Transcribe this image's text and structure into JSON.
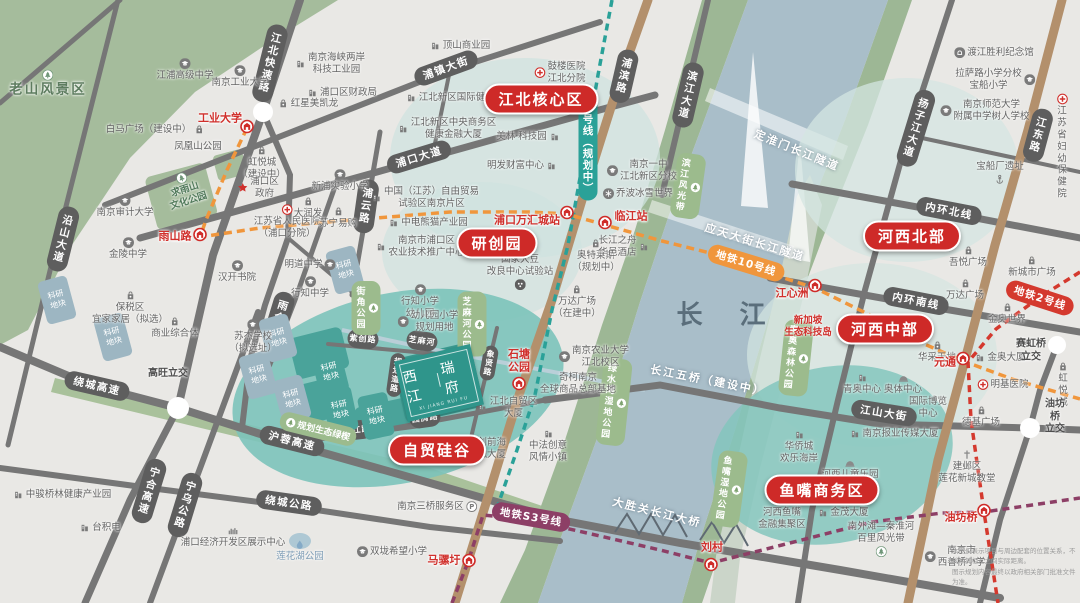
{
  "map": {
    "project_logo": {
      "name": "西江瑞府",
      "line1": "西江",
      "line2": "瑞府",
      "sub": "XI JIANG RUI FU"
    },
    "river_label": "长 江",
    "disclaimer_line1": "本图仅表示项目与周边配套的位置关系，不反映其相互之间实际距离。",
    "disclaimer_line2": "图示规划内容最终以政府相关部门批准文件为准。",
    "research_block_label": "科研\n地块",
    "colors": {
      "badge_red": "#ce2a28",
      "metro10_orange": "#f0963c",
      "metro11_teal": "#2aa198",
      "metro2_red": "#d4392e",
      "metroS3_purple": "#8d3f66",
      "road_gray": "#767676",
      "avenue_tan": "#b3906c",
      "river_blue": "#a9bec9",
      "park_green": "#a5bc9c",
      "zone_teal": "#7cc3ba"
    },
    "area_badges": [
      {
        "t": "江北核心区",
        "x": 541,
        "y": 99
      },
      {
        "t": "研创园",
        "x": 497,
        "y": 243
      },
      {
        "t": "自贸硅谷",
        "x": 437,
        "y": 450
      },
      {
        "t": "河西北部",
        "x": 912,
        "y": 236
      },
      {
        "t": "河西中部",
        "x": 885,
        "y": 329
      },
      {
        "t": "鱼嘴商务区",
        "x": 822,
        "y": 490
      }
    ],
    "metro_pills": [
      {
        "t": "11号线（规划中）",
        "x": 588,
        "y": 145,
        "vert": 1,
        "color": "#2aa198"
      },
      {
        "t": "地铁10号线",
        "x": 746,
        "y": 263,
        "rot": 17,
        "color": "#f0963c"
      },
      {
        "t": "地铁2号线",
        "x": 1040,
        "y": 298,
        "rot": 18,
        "color": "#d4392e"
      },
      {
        "t": "地铁S3号线",
        "x": 531,
        "y": 517,
        "rot": 10,
        "color": "#8d3f66"
      }
    ],
    "stations": [
      {
        "t": "工业大学",
        "ix": 247,
        "iy": 128,
        "tx": 220,
        "ty": 119
      },
      {
        "t": "雨山路",
        "ix": 200,
        "iy": 236,
        "tx": 175,
        "ty": 237
      },
      {
        "t": "浦口万汇城站",
        "ix": 567,
        "iy": 214,
        "tx": 527,
        "ty": 221
      },
      {
        "t": "临江站",
        "ix": 605,
        "iy": 224,
        "tx": 631,
        "ty": 217
      },
      {
        "t": "石塘\n公园",
        "ix": 519,
        "iy": 385,
        "tx": 519,
        "ty": 361
      },
      {
        "t": "江心洲",
        "ix": 815,
        "iy": 287,
        "tx": 792,
        "ty": 294
      },
      {
        "t": "元通",
        "ix": 963,
        "iy": 360,
        "tx": 945,
        "ty": 363
      },
      {
        "t": "油坊桥",
        "ix": 984,
        "iy": 512,
        "tx": 961,
        "ty": 518
      },
      {
        "t": "马骡圩",
        "ix": 469,
        "iy": 562,
        "tx": 444,
        "ty": 561
      },
      {
        "t": "刘村",
        "ix": 711,
        "iy": 566,
        "tx": 712,
        "ty": 548
      }
    ],
    "road_pills": [
      {
        "t": "江北快速路",
        "x": 270,
        "y": 63,
        "vert": 1,
        "rot": 14
      },
      {
        "t": "浦镇大街",
        "x": 446,
        "y": 68,
        "rot": -20
      },
      {
        "t": "浦口大道",
        "x": 419,
        "y": 157,
        "rot": -17
      },
      {
        "t": "浦云路",
        "x": 366,
        "y": 206,
        "vert": 1,
        "rot": 8
      },
      {
        "t": "浦滨路",
        "x": 624,
        "y": 76,
        "vert": 1,
        "rot": 13
      },
      {
        "t": "滨江大道",
        "x": 688,
        "y": 95,
        "vert": 1,
        "rot": 13
      },
      {
        "t": "扬子江大道",
        "x": 916,
        "y": 128,
        "vert": 1,
        "rot": 17
      },
      {
        "t": "江东路",
        "x": 1038,
        "y": 135,
        "vert": 1,
        "rot": 15
      },
      {
        "t": "沿山大道",
        "x": 63,
        "y": 239,
        "vert": 1,
        "rot": 14
      },
      {
        "t": "雨合路",
        "x": 279,
        "y": 318,
        "vert": 1,
        "rot": 17
      },
      {
        "t": "绕城高速",
        "x": 97,
        "y": 386,
        "rot": 13
      },
      {
        "t": "沪蓉高速",
        "x": 292,
        "y": 441,
        "rot": 14
      },
      {
        "t": "宁合高速",
        "x": 149,
        "y": 491,
        "vert": 1,
        "rot": 17
      },
      {
        "t": "宁乌公路",
        "x": 185,
        "y": 505,
        "vert": 1,
        "rot": 17
      },
      {
        "t": "绕城公路",
        "x": 289,
        "y": 503,
        "rot": 8
      },
      {
        "t": "内环北线",
        "x": 949,
        "y": 211,
        "rot": 11
      },
      {
        "t": "内环南线",
        "x": 916,
        "y": 301,
        "rot": 11
      },
      {
        "t": "江山大街",
        "x": 884,
        "y": 413,
        "rot": 9
      },
      {
        "t": "紫创路",
        "x": 363,
        "y": 339,
        "rot": 5,
        "small": 1
      },
      {
        "t": "象贤路",
        "x": 489,
        "y": 363,
        "vert": 1,
        "rot": 10,
        "small": 1
      },
      {
        "t": "园腾路",
        "x": 425,
        "y": 418,
        "rot": -8,
        "small": 1
      },
      {
        "t": "西江路",
        "x": 357,
        "y": 430,
        "rot": -6,
        "small": 1
      },
      {
        "t": "规划道路",
        "x": 396,
        "y": 375,
        "vert": 1,
        "rot": 8,
        "small": 1
      },
      {
        "t": "芝麻河",
        "x": 422,
        "y": 341,
        "rot": 8,
        "small": 1
      }
    ],
    "white_labels": [
      {
        "t": "定淮门长江隧道",
        "x": 797,
        "y": 150,
        "rot": 22
      },
      {
        "t": "应天大街长江隧道",
        "x": 755,
        "y": 242,
        "rot": 17
      },
      {
        "t": "长江五桥（建设中）",
        "x": 708,
        "y": 380,
        "rot": 11
      },
      {
        "t": "大胜关长江大桥",
        "x": 657,
        "y": 512,
        "rot": 14
      }
    ],
    "green_labels": [
      {
        "t": "芝麻河公园",
        "x": 472,
        "y": 324,
        "vert": 1
      },
      {
        "t": "街角公园",
        "x": 366,
        "y": 308,
        "vert": 1
      },
      {
        "t": "滨江风光带",
        "x": 688,
        "y": 186,
        "vert": 1,
        "rot": 8
      },
      {
        "t": "青奥森林公园",
        "x": 796,
        "y": 358,
        "vert": 1,
        "rot": 6
      },
      {
        "t": "绿水湾湿地公园",
        "x": 614,
        "y": 402,
        "vert": 1,
        "rot": 6
      },
      {
        "t": "鱼嘴湿地公园",
        "x": 729,
        "y": 489,
        "vert": 1,
        "rot": 8
      },
      {
        "t": "规划生态绿楔",
        "x": 318,
        "y": 429,
        "rot": 14
      }
    ],
    "research_blocks": [
      {
        "x": 57,
        "y": 300,
        "rot": -15
      },
      {
        "x": 113,
        "y": 337,
        "rot": -15
      },
      {
        "x": 278,
        "y": 338,
        "rot": -15
      },
      {
        "x": 258,
        "y": 375,
        "rot": -15
      },
      {
        "x": 292,
        "y": 399,
        "rot": -15
      },
      {
        "x": 345,
        "y": 270,
        "rot": -15
      },
      {
        "x": 330,
        "y": 372,
        "rot": -14,
        "teal": 1
      },
      {
        "x": 340,
        "y": 410,
        "rot": -12,
        "teal": 1
      },
      {
        "x": 376,
        "y": 416,
        "rot": -12,
        "teal": 1
      }
    ],
    "pois": [
      {
        "t": "老山风景区",
        "x": 48,
        "y": 84,
        "cls": "green-big",
        "ic": "tree",
        "pos": "top"
      },
      {
        "t": "凤凰山公园",
        "x": 198,
        "y": 147
      },
      {
        "t": "求雨山\n文化公园",
        "x": 185,
        "y": 190,
        "cls": "green",
        "ic": "tree",
        "pos": "top",
        "rot": -18
      },
      {
        "t": "江浦高级中学",
        "x": 185,
        "y": 70,
        "ic": "school",
        "pos": "top"
      },
      {
        "t": "南京工业大学",
        "x": 240,
        "y": 77,
        "ic": "school",
        "pos": "top"
      },
      {
        "t": "南京海峡两岸\n科技工业园",
        "x": 330,
        "y": 64,
        "ic": "bld",
        "pos": "left"
      },
      {
        "t": "红星美凯龙",
        "x": 308,
        "y": 104,
        "ic": "bag",
        "pos": "left"
      },
      {
        "t": "浦口区财政局",
        "x": 342,
        "y": 93,
        "ic": "bld",
        "pos": "left"
      },
      {
        "t": "白马广场（建设中）",
        "x": 155,
        "y": 130,
        "ic": "bag",
        "pos": "right"
      },
      {
        "t": "虹悦城\n（建设中）",
        "x": 262,
        "y": 163,
        "ic": "bag",
        "pos": "top"
      },
      {
        "t": "浦口区\n政府",
        "x": 258,
        "y": 188,
        "ic": "star",
        "pos": "left"
      },
      {
        "t": "新浦实验小学",
        "x": 340,
        "y": 181,
        "ic": "school",
        "pos": "top"
      },
      {
        "t": "南京审计大学",
        "x": 125,
        "y": 207,
        "ic": "school",
        "pos": "top"
      },
      {
        "t": "金陵中学",
        "x": 128,
        "y": 249,
        "ic": "school",
        "pos": "top"
      },
      {
        "t": "江苏省人民医院\n（浦口分院）",
        "x": 287,
        "y": 222,
        "ic": "hosp",
        "pos": "top"
      },
      {
        "t": "大润发",
        "x": 308,
        "y": 208,
        "ic": "bag",
        "pos": "top"
      },
      {
        "t": "苏宁易购",
        "x": 338,
        "y": 218,
        "ic": "bag",
        "pos": "top"
      },
      {
        "t": "汉开书院",
        "x": 237,
        "y": 272,
        "ic": "school",
        "pos": "top"
      },
      {
        "t": "明道中学",
        "x": 310,
        "y": 265,
        "ic": "school",
        "pos": "right"
      },
      {
        "t": "行知中学",
        "x": 310,
        "y": 288,
        "ic": "school",
        "pos": "top"
      },
      {
        "t": "保税区\n宜家家居（拟选）",
        "x": 130,
        "y": 308,
        "ic": "bag",
        "pos": "top"
      },
      {
        "t": "商业综合体",
        "x": 175,
        "y": 328,
        "ic": "bag",
        "pos": "top"
      },
      {
        "t": "苏杰学校\n（拟选址）",
        "x": 253,
        "y": 337,
        "ic": "school",
        "pos": "top"
      },
      {
        "t": "高旺立交",
        "x": 168,
        "y": 374,
        "cls": "dark"
      },
      {
        "t": "顶山商业园",
        "x": 460,
        "y": 46,
        "ic": "bld",
        "pos": "left"
      },
      {
        "t": "鼓楼医院\n江北分院",
        "x": 560,
        "y": 73,
        "ic": "hosp",
        "pos": "left"
      },
      {
        "t": "江北新区国际健康城",
        "x": 455,
        "y": 98,
        "ic": "bld",
        "pos": "left"
      },
      {
        "t": "江北新区中央商务区\n健康金融大厦",
        "x": 447,
        "y": 129,
        "ic": "bld",
        "pos": "left"
      },
      {
        "t": "美林·科技园",
        "x": 528,
        "y": 137,
        "ic": "bld",
        "pos": "right"
      },
      {
        "t": "明发财富中心",
        "x": 522,
        "y": 166,
        "ic": "bld",
        "pos": "right"
      },
      {
        "t": "中国（江苏）自由贸易\n试验区南京片区",
        "x": 425,
        "y": 198,
        "ic": "bld",
        "pos": "left"
      },
      {
        "t": "中电熊猫产业园",
        "x": 428,
        "y": 223,
        "ic": "bld",
        "pos": "left"
      },
      {
        "t": "南京市浦口区\n农业技术推广中心",
        "x": 420,
        "y": 247,
        "ic": "bld",
        "pos": "left"
      },
      {
        "t": "国家大豆\n改良中心试验站",
        "x": 520,
        "y": 272,
        "ic": "dots",
        "pos": "bottom"
      },
      {
        "t": "行知小学\n幼儿园",
        "x": 420,
        "y": 302,
        "ic": "school",
        "pos": "top"
      },
      {
        "t": "幼儿园小学\n规划用地",
        "x": 428,
        "y": 322,
        "ic": "school",
        "pos": "left"
      },
      {
        "t": "奥特莱斯\n（规划中）",
        "x": 596,
        "y": 256,
        "ic": "bag",
        "pos": "top"
      },
      {
        "t": "长江之舟\n华邑酒店",
        "x": 624,
        "y": 247,
        "ic": "bld",
        "pos": "right"
      },
      {
        "t": "万达广场\n（在建中）",
        "x": 577,
        "y": 302,
        "ic": "bag",
        "pos": "top"
      },
      {
        "t": "南京一中\n江北新区分校",
        "x": 642,
        "y": 171,
        "ic": "school",
        "pos": "left"
      },
      {
        "t": "乔波冰雪世界",
        "x": 638,
        "y": 194,
        "ic": "snow",
        "pos": "left"
      },
      {
        "t": "南京农业大学\n江北校区",
        "x": 594,
        "y": 357,
        "ic": "school",
        "pos": "left"
      },
      {
        "t": "奇柯南京\n全球商品总部基地",
        "x": 578,
        "y": 384
      },
      {
        "t": "渡江胜利纪念馆",
        "x": 994,
        "y": 53,
        "ic": "museum",
        "pos": "left"
      },
      {
        "t": "拉萨路小学分校\n宝船小学",
        "x": 995,
        "y": 80,
        "ic": "school",
        "pos": "right"
      },
      {
        "t": "南京师范大学\n附属中学树人学校",
        "x": 985,
        "y": 111,
        "ic": "school",
        "pos": "left"
      },
      {
        "t": "江苏省\n妇幼保健院",
        "x": 1062,
        "y": 147,
        "ic": "hosp",
        "pos": "top"
      },
      {
        "t": "宝船厂遗址",
        "x": 1000,
        "y": 173,
        "ic": "anchor",
        "pos": "bottom"
      },
      {
        "t": "吾悦广场",
        "x": 968,
        "y": 257,
        "ic": "bag",
        "pos": "top"
      },
      {
        "t": "新城市广场",
        "x": 1032,
        "y": 267,
        "ic": "bag",
        "pos": "top"
      },
      {
        "t": "万达广场",
        "x": 965,
        "y": 290,
        "ic": "bag",
        "pos": "top"
      },
      {
        "t": "金奥世界",
        "x": 1007,
        "y": 314,
        "ic": "bag",
        "pos": "top"
      },
      {
        "t": "华采天地",
        "x": 937,
        "y": 352,
        "ic": "bag",
        "pos": "top"
      },
      {
        "t": "金奥大厦",
        "x": 1000,
        "y": 358,
        "ic": "bld",
        "pos": "left"
      },
      {
        "t": "赛虹桥\n立交",
        "x": 1031,
        "y": 351,
        "cls": "dark"
      },
      {
        "t": "青奥中心",
        "x": 862,
        "y": 384,
        "ic": "bld",
        "pos": "top"
      },
      {
        "t": "奥体中心",
        "x": 903,
        "y": 384,
        "ic": "dome",
        "pos": "top"
      },
      {
        "t": "明基医院",
        "x": 1003,
        "y": 385,
        "ic": "hosp",
        "pos": "left"
      },
      {
        "t": "虹悦城",
        "x": 1063,
        "y": 385,
        "ic": "bag",
        "pos": "top"
      },
      {
        "t": "德基广场",
        "x": 981,
        "y": 417,
        "ic": "bag",
        "pos": "top"
      },
      {
        "t": "国际博览\n中心",
        "x": 928,
        "y": 408
      },
      {
        "t": "油坊桥\n立交",
        "x": 1055,
        "y": 417,
        "cls": "dark"
      },
      {
        "t": "新加坡\n生态科技岛",
        "x": 808,
        "y": 327,
        "cls": "red"
      },
      {
        "t": "华侨城\n欢乐海岸",
        "x": 799,
        "y": 447,
        "ic": "bld",
        "pos": "top"
      },
      {
        "t": "南京报业传媒大厦",
        "x": 894,
        "y": 434,
        "ic": "bld",
        "pos": "left"
      },
      {
        "t": "河西儿童乐园",
        "x": 850,
        "y": 469,
        "ic": "dome",
        "pos": "top"
      },
      {
        "t": "河西鱼嘴\n金融集聚区",
        "x": 782,
        "y": 519
      },
      {
        "t": "金茂大厦",
        "x": 843,
        "y": 513,
        "ic": "bld",
        "pos": "left"
      },
      {
        "t": "建邺区\n莲花新城教堂",
        "x": 967,
        "y": 467,
        "ic": "church",
        "pos": "top"
      },
      {
        "t": "南外滩—秦淮河\n百里风光带",
        "x": 881,
        "y": 539,
        "ic": "tree",
        "pos": "bottom"
      },
      {
        "t": "南京市\n西善桥小学",
        "x": 955,
        "y": 557,
        "ic": "school",
        "pos": "left"
      },
      {
        "t": "江北自贸区\n大厦",
        "x": 507,
        "y": 408,
        "ic": "bld",
        "pos": "left"
      },
      {
        "t": "科创前海\n金融大厦",
        "x": 487,
        "y": 449
      },
      {
        "t": "中法创意\n风情小镇",
        "x": 548,
        "y": 446,
        "ic": "bld",
        "pos": "top"
      },
      {
        "t": "南京三桥服务区",
        "x": 437,
        "y": 507,
        "ic": "parkP",
        "pos": "right"
      },
      {
        "t": "双垅希望小学",
        "x": 392,
        "y": 552,
        "ic": "school",
        "pos": "left"
      },
      {
        "t": "浦口经济开发区展示中心",
        "x": 233,
        "y": 537,
        "ic": "skyline",
        "pos": "top"
      },
      {
        "t": "莲花湖公园",
        "x": 300,
        "y": 551,
        "cls": "blue",
        "ic": "drop",
        "pos": "top"
      },
      {
        "t": "台积电",
        "x": 100,
        "y": 528,
        "ic": "bld",
        "pos": "left"
      },
      {
        "t": "中骏桥林健康产业园",
        "x": 62,
        "y": 495,
        "ic": "bld",
        "pos": "left"
      }
    ]
  }
}
